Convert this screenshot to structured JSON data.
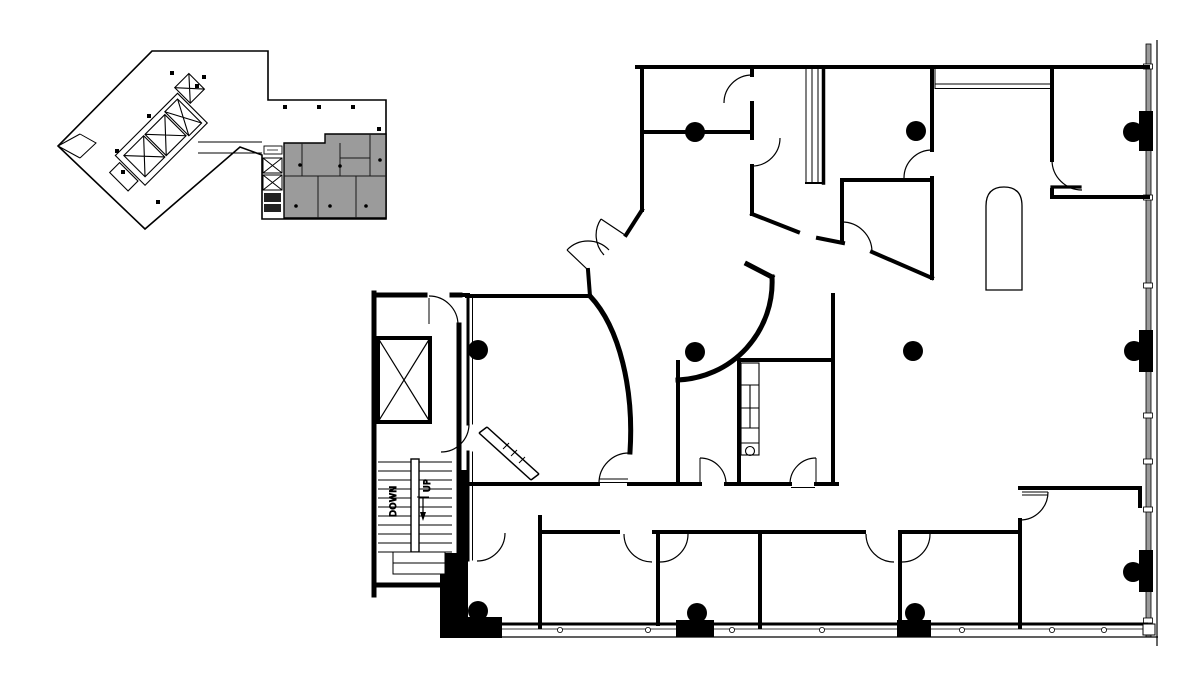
{
  "document": {
    "kind": "Office floor plan drawing with key plan inset",
    "background": "#ffffff"
  },
  "colors": {
    "ink": "#000000",
    "suite_fill": "#9b9b9b",
    "curtain_fill": "#9a9a9a",
    "paper": "#ffffff"
  },
  "key_plan": {
    "description": "Small building key plan, tenant suite shaded gray"
  },
  "main_plan": {
    "stair": {
      "down_label": "DOWN",
      "up_label": "UP"
    },
    "column_dots": 11
  }
}
